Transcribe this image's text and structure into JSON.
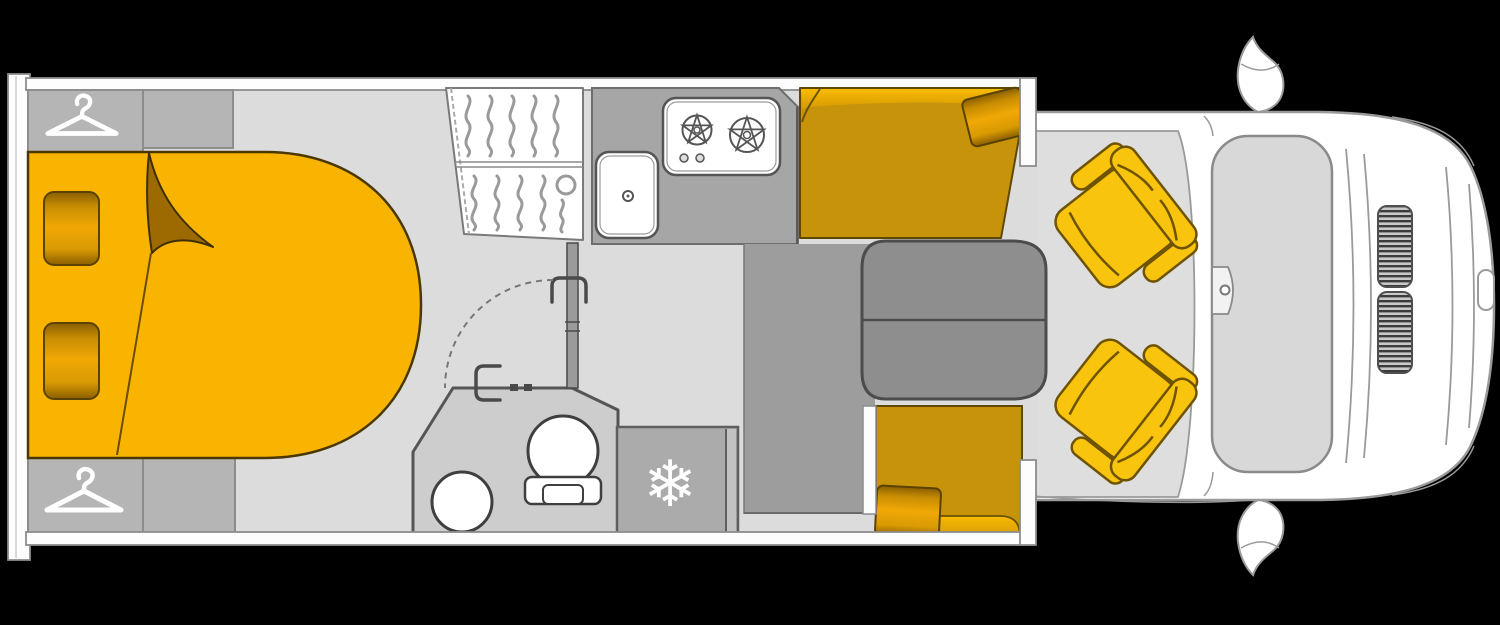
{
  "canvas": {
    "width": 1500,
    "height": 625,
    "background": "#000000"
  },
  "palette": {
    "floor": "#dcdcdc",
    "wall_fill": "#fdfdfd",
    "wall_stroke": "#8c8c8c",
    "cabinet": "#b5b5b5",
    "bed": "#f8b400",
    "fold": "#9c6a00",
    "bench": "#c6930a",
    "bench_highlight": "#f2ae03",
    "seat": "#f8c40e",
    "table": "#8e8e8e",
    "platform": "#9d9d9d",
    "counter": "#a6a6a6",
    "bathroom": "#cdcdcd",
    "fridge": "#ababab",
    "vehicle_body": "#ffffff",
    "glass": "#d8d8d8",
    "grille_dark": "#3c3c3c",
    "icon_white": "#ffffff"
  },
  "icons": {
    "snowflake_glyph": "❄",
    "snowflake": "snowflake-icon",
    "hanger": "clothes-hanger-icon",
    "burner": "gas-burner-icon"
  }
}
